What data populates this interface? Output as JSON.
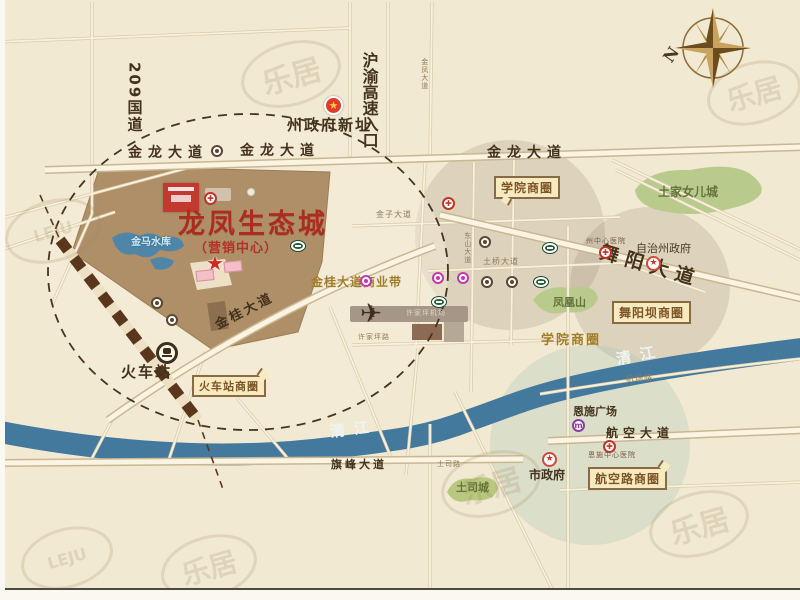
{
  "project": {
    "title": "龙凤生态城",
    "subtitle": "（营销中心）"
  },
  "roads": {
    "g209": "209国道",
    "expressway": "沪渝高速入口",
    "jinlong": "金龙大道",
    "jingui": "金桂大道",
    "wuyang": "舞阳大道",
    "hangkong": "航空大道",
    "qifeng": "旗峰大道",
    "tuqiao": "土桥大道",
    "tusi": "土司路",
    "jichang": "机场路",
    "jinfeng": "金凤大道",
    "jinzi": "金子大道",
    "dongshan": "东山大道",
    "xujiaping": "许家坪路"
  },
  "places": {
    "gov_new": "州政府新址",
    "station": "火车站",
    "reservoir": "金马水库",
    "airport": "许家坪机场",
    "phoenix": "凤凰山",
    "nver": "土家女儿城",
    "tusi_city": "土司城",
    "square": "恩施广场",
    "city_gov": "市政府",
    "pref_gov": "自治州政府",
    "state_hosp": "州中心医院",
    "central_hosp": "恩施中心医院"
  },
  "zones": {
    "xueyuan": "学院商圈",
    "wuyangba": "舞阳坝商圈",
    "station_zone": "火车站商圈",
    "hangkong_zone": "航空路商圈",
    "belt": "金桂大道商业带"
  },
  "river": {
    "name": "清江"
  },
  "compass": {
    "north": "N"
  },
  "watermark": {
    "text": "乐居",
    "latin": "LEJU"
  },
  "icons": {
    "star": "★",
    "hospital": "✚",
    "plane": "✈"
  },
  "colors": {
    "project_fill": "#ae8f68",
    "river": "#44799e",
    "title_red": "#ab2d20",
    "road_text": "#43321c",
    "zone_gold": "#a07d2a",
    "green_area": "#b8cb8d"
  }
}
